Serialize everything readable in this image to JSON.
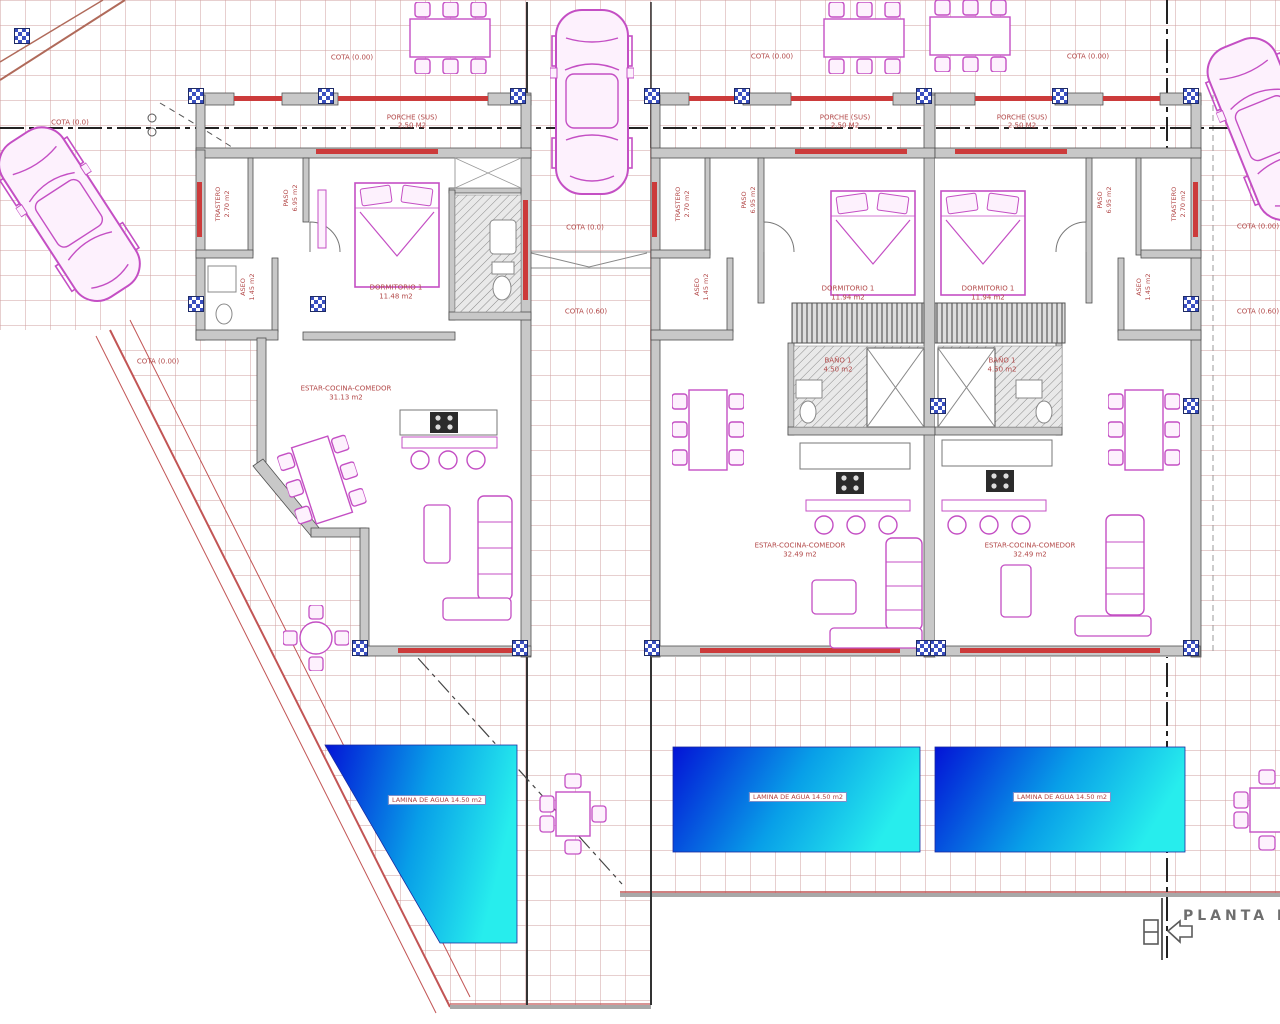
{
  "plan": {
    "title": "PLANTA BA",
    "cotas": [
      "COTA (0.0)",
      "COTA (0.00)",
      "COTA (0.00)",
      "COTA (0.00)",
      "COTA (0.0)",
      "COTA (0.60)",
      "COTA (0.00)",
      "COTA (0.00)",
      "COTA (0.60)"
    ],
    "porches": [
      {
        "name": "PORCHE (SUS)",
        "area": "2.50 M2"
      },
      {
        "name": "PORCHE (SUS)",
        "area": "2.50 M2"
      },
      {
        "name": "PORCHE (SUS)",
        "area": "2.50 M2"
      }
    ],
    "houses": [
      {
        "id": "house-left",
        "rooms": {
          "trastero": {
            "name": "TRASTERO",
            "area": "2.70 m2"
          },
          "paso": {
            "name": "PASO",
            "area": "6.95 m2"
          },
          "aseo": {
            "name": "ASEO",
            "area": "1.45 m2"
          },
          "dormitorio": {
            "name": "DORMITORIO 1",
            "area": "11.48 m2"
          },
          "estar": {
            "name": "ESTAR-COCINA-COMEDOR",
            "area": "31.13 m2"
          }
        }
      },
      {
        "id": "house-middle",
        "rooms": {
          "trastero": {
            "name": "TRASTERO",
            "area": "2.70 m2"
          },
          "paso": {
            "name": "PASO",
            "area": "6.95 m2"
          },
          "aseo": {
            "name": "ASEO",
            "area": "1.45 m2"
          },
          "dormitorio": {
            "name": "DORMITORIO 1",
            "area": "11.94 m2"
          },
          "bano": {
            "name": "BAÑO 1",
            "area": "4.50 m2"
          },
          "estar": {
            "name": "ESTAR-COCINA-COMEDOR",
            "area": "32.49 m2"
          }
        }
      },
      {
        "id": "house-right",
        "rooms": {
          "trastero": {
            "name": "TRASTERO",
            "area": "2.70 m2"
          },
          "paso": {
            "name": "PASO",
            "area": "6.95 m2"
          },
          "aseo": {
            "name": "ASEO",
            "area": "1.45 m2"
          },
          "dormitorio": {
            "name": "DORMITORIO 1",
            "area": "11.94 m2"
          },
          "bano": {
            "name": "BAÑO 1",
            "area": "4.50 m2"
          },
          "estar": {
            "name": "ESTAR-COCINA-COMEDOR",
            "area": "32.49 m2"
          }
        }
      }
    ],
    "pools": [
      {
        "label": "LAMINA DE AGUA 14.50 m2"
      },
      {
        "label": "LAMINA DE AGUA 14.50 m2"
      },
      {
        "label": "LAMINA DE AGUA 14.50 m2"
      }
    ],
    "colors": {
      "pool_gradient_start": "#0313d6",
      "pool_gradient_end": "#27eded",
      "furniture_magenta": "#c44fc4",
      "boundary_red": "#c25555",
      "wall_gray": "#c8c8c8",
      "grid_pink": "#cf9f9f",
      "column_marker_blue": "#3a4fc0"
    }
  }
}
